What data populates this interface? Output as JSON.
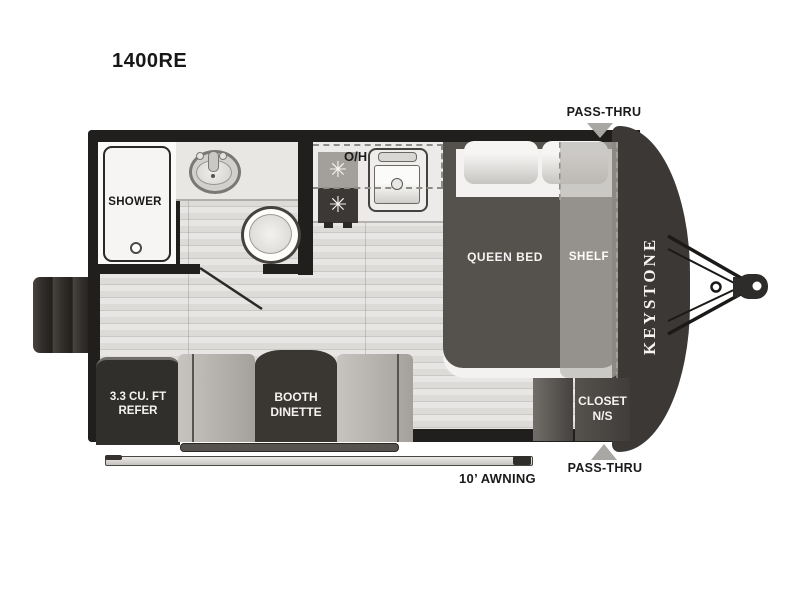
{
  "title": "1400RE",
  "brand_vertical": "KEYSTONE",
  "rooms": {
    "shower": "SHOWER",
    "overhead_cabinet": "O/H",
    "queen_bed": "QUEEN BED",
    "shelf": "SHELF",
    "refer": {
      "line1": "3.3 CU. FT",
      "line2": "REFER"
    },
    "dinette": {
      "line1": "BOOTH",
      "line2": "DINETTE"
    },
    "closet": {
      "line1": "CLOSET",
      "line2": "N/S"
    }
  },
  "callouts": {
    "pass_thru_top": "PASS-THRU",
    "pass_thru_bottom": "PASS-THRU",
    "awning": "10’ AWNING"
  },
  "icons": {
    "burner_glyph": "✳",
    "pass_thru_arrow": "triangle",
    "hitch": "a-frame-tongue"
  },
  "colors": {
    "wall": "#211f1d",
    "front_cap": "#3b3835",
    "mattress": "#55524e",
    "shelf_overlay": "#b6b3af",
    "dark_furniture": "#3a3733",
    "bench": "#b5b2ae",
    "floor_plank_light": "#e7e6e4",
    "floor_plank_dark": "#c9c8c5",
    "arrow_gray": "#a9a7a4",
    "counter": "#ecebe9"
  }
}
